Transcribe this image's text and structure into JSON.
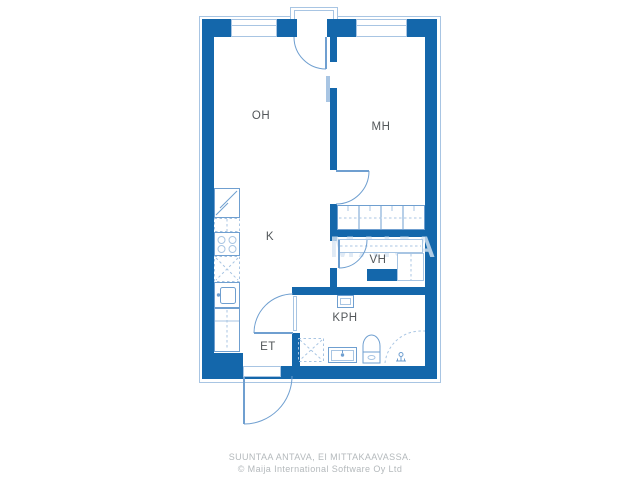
{
  "plan": {
    "type": "apartment-floor-plan",
    "rooms": [
      {
        "id": "oh",
        "label": "OH"
      },
      {
        "id": "mh",
        "label": "MH"
      },
      {
        "id": "k",
        "label": "K"
      },
      {
        "id": "vh",
        "label": "VH"
      },
      {
        "id": "kph",
        "label": "KPH"
      },
      {
        "id": "et",
        "label": "ET"
      }
    ],
    "fixtures": {
      "kitchen": [
        "refrigerator",
        "counter-space",
        "stove-4-burners",
        "dishwasher-space",
        "sink",
        "lower-cabinet"
      ],
      "bedroom": [
        "wardrobe-row-4-sections"
      ],
      "walk-in-closet": [
        "shelf-row",
        "cabinet"
      ],
      "bathroom": [
        "ventilation-duct",
        "washing-machine-space",
        "washbasin",
        "toilet",
        "shower-area",
        "floor-drain"
      ],
      "doors": [
        "balcony-door",
        "bedroom-door",
        "closet-door",
        "bathroom-door",
        "front-door",
        "sliding-panel"
      ],
      "windows": [
        "living-room-window",
        "bedroom-window"
      ]
    },
    "watermark": "MAIJA"
  },
  "footer": {
    "line1": "SUUNTAA ANTAVA, EI MITTAKAAVASSA.",
    "line2": "© Maija International Software Oy Ltd"
  },
  "colors": {
    "wall": "#1467ab",
    "line": "#6f9fd0",
    "light": "#a8c5e3",
    "label": "#53575a",
    "footer": "#b4b9bc",
    "bg": "#ffffff"
  }
}
